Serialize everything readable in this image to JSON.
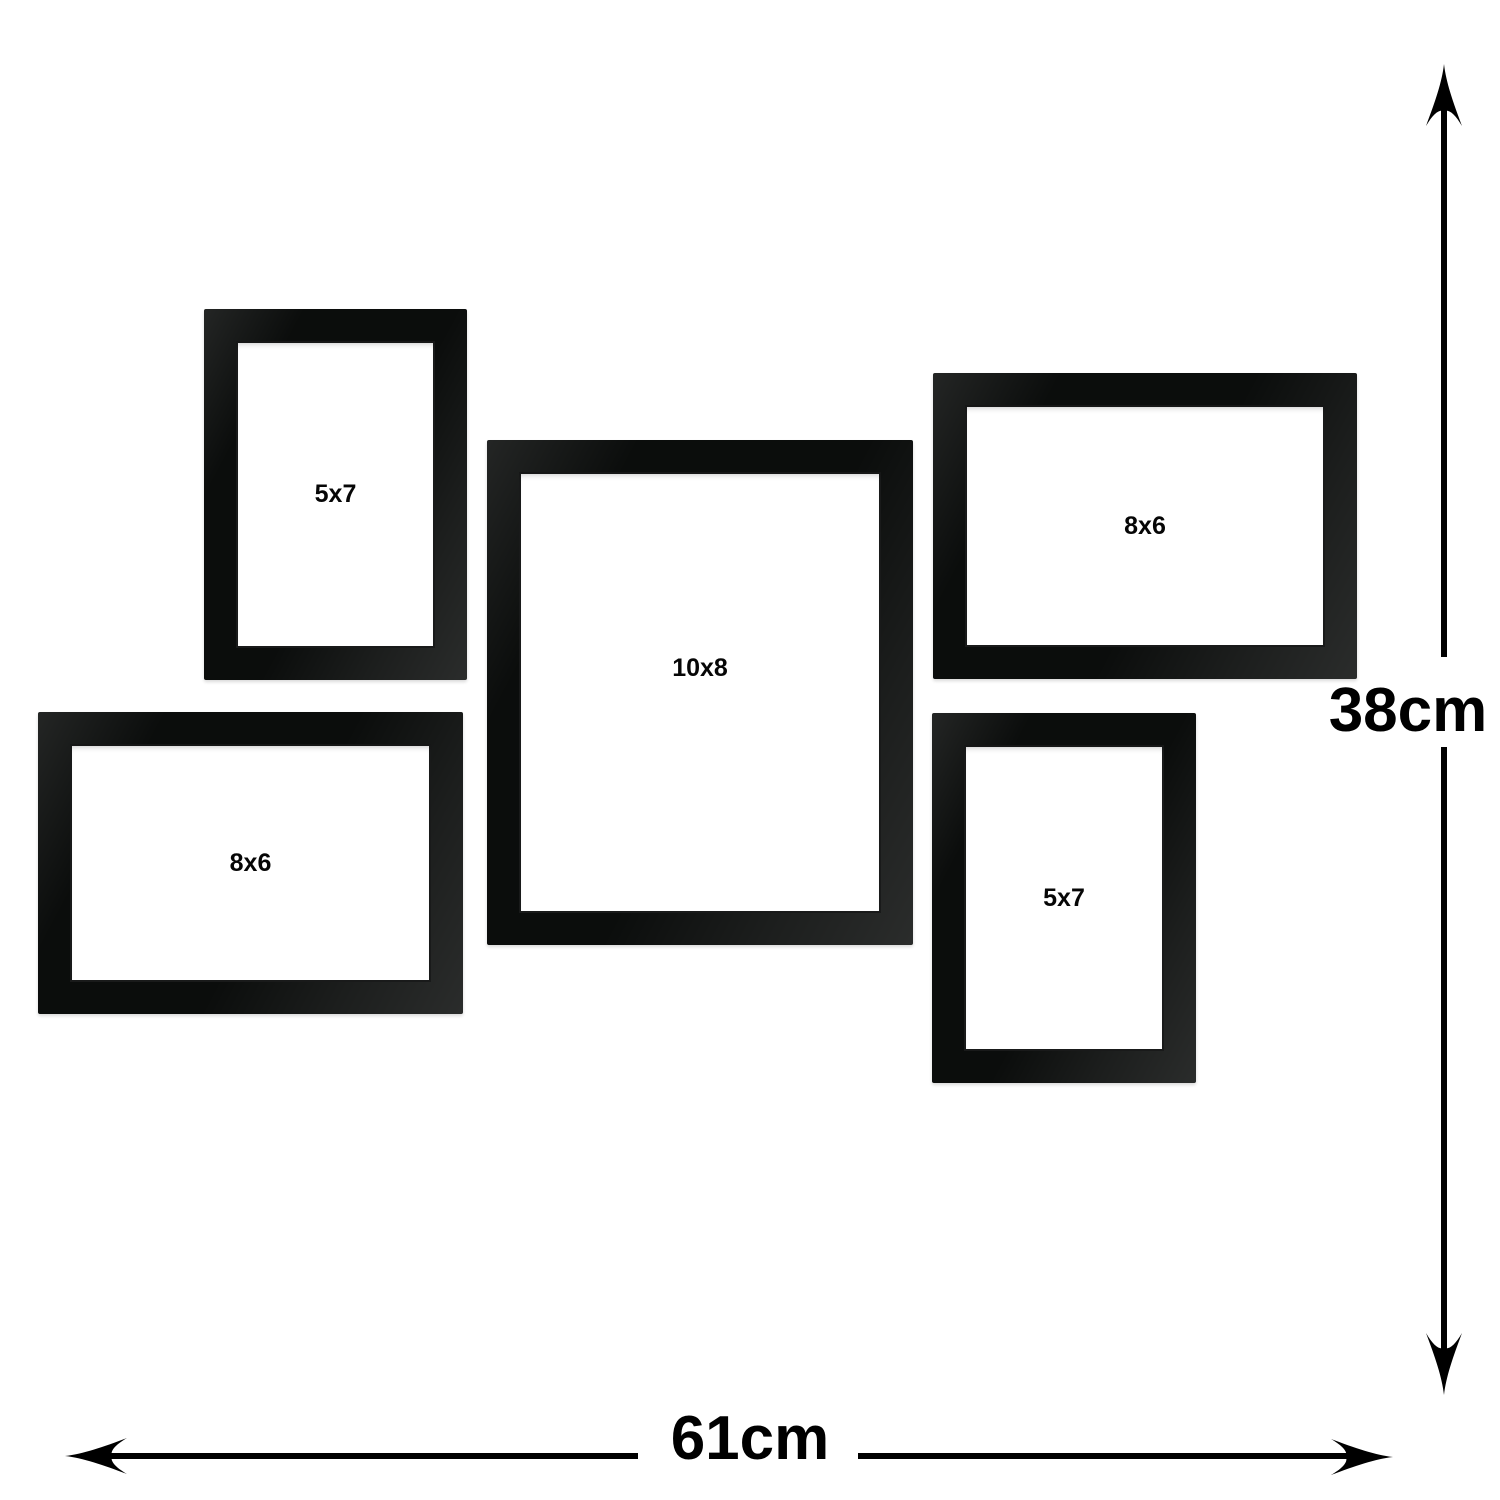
{
  "frames": [
    {
      "label": "5x7",
      "position": "top-left",
      "orientation": "portrait"
    },
    {
      "label": "10x8",
      "position": "center",
      "orientation": "portrait"
    },
    {
      "label": "8x6",
      "position": "top-right",
      "orientation": "landscape"
    },
    {
      "label": "8x6",
      "position": "bottom-left",
      "orientation": "landscape"
    },
    {
      "label": "5x7",
      "position": "bottom-right",
      "orientation": "portrait"
    }
  ],
  "dimensions": {
    "height_label": "38cm",
    "width_label": "61cm"
  },
  "colors": {
    "frame_black": "#0b0d0c",
    "arrow_black": "#000000",
    "label_black": "#000000",
    "background_white": "#ffffff"
  }
}
